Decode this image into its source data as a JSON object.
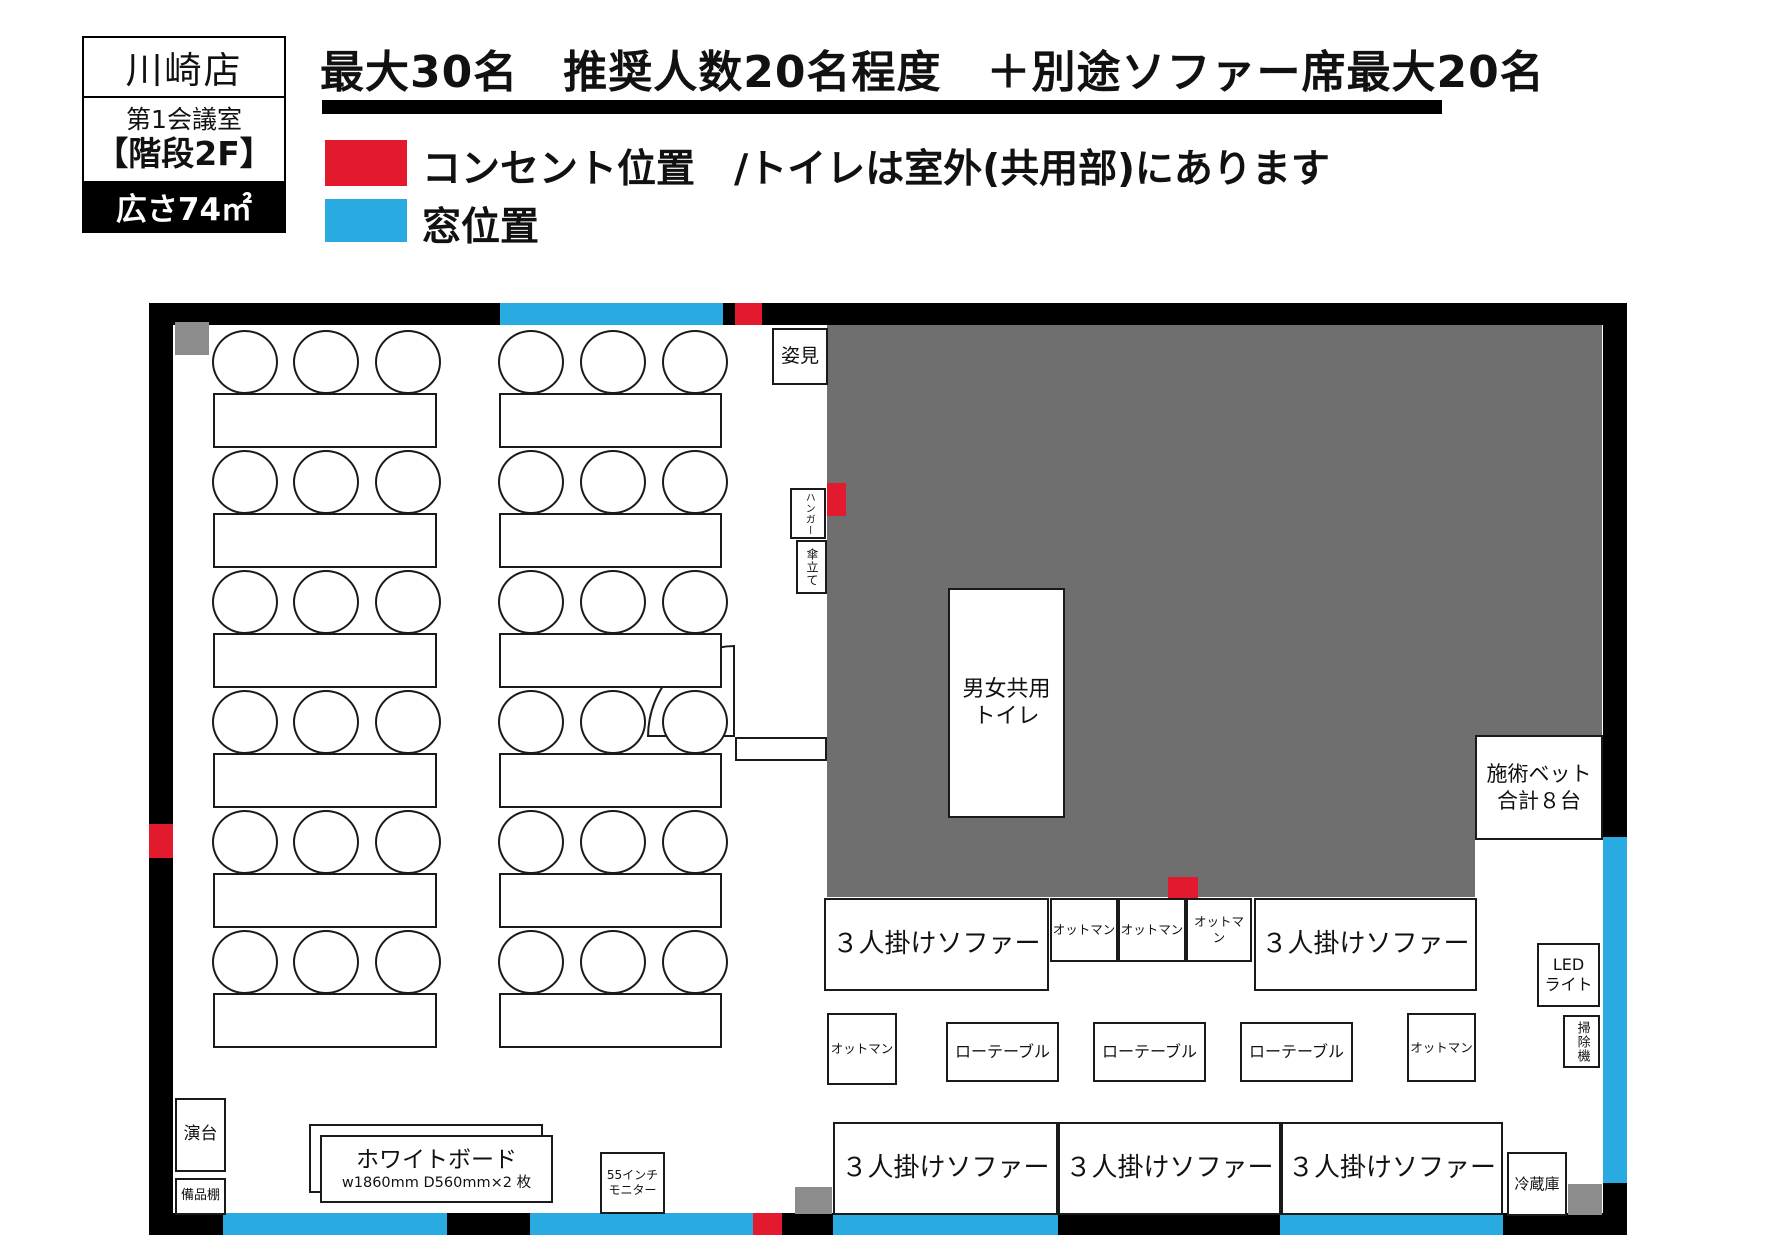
{
  "info_card": {
    "store": "川崎店",
    "room": "第1会議室",
    "floor_note": "【階段2F】",
    "area": "広さ74㎡"
  },
  "headline": "最大30名　推奨人数20名程度　＋別途ソファー席最大20名",
  "legend": {
    "outlet_label": "コンセント位置　/トイレは室外(共用部)にあります",
    "window_label": "窓位置"
  },
  "colors": {
    "outlet_red": "#e3192d",
    "window_blue": "#29abe2",
    "zone_gray": "#6f6f6f",
    "object_gray": "#8c8c8c",
    "wall": "#000000"
  },
  "plan": {
    "mirror": "姿見",
    "hanger": "ハンガー",
    "umbrella_stand": "傘立て",
    "toilet_line1": "男女共用",
    "toilet_line2": "トイレ",
    "treatment_bed_line1": "施術ベット",
    "treatment_bed_line2": "合計８台",
    "sofa": "３人掛けソファー",
    "ottoman": "オットマン",
    "low_table": "ローテーブル",
    "led_line1": "LED",
    "led_line2": "ライト",
    "vacuum": "掃除機",
    "fridge": "冷蔵庫",
    "lectern": "演台",
    "shelf": "備品棚",
    "whiteboard": "ホワイトボード",
    "whiteboard_spec": "w1860mm D560mm×2 枚",
    "monitor_line1": "55インチ",
    "monitor_line2": "モニター"
  }
}
